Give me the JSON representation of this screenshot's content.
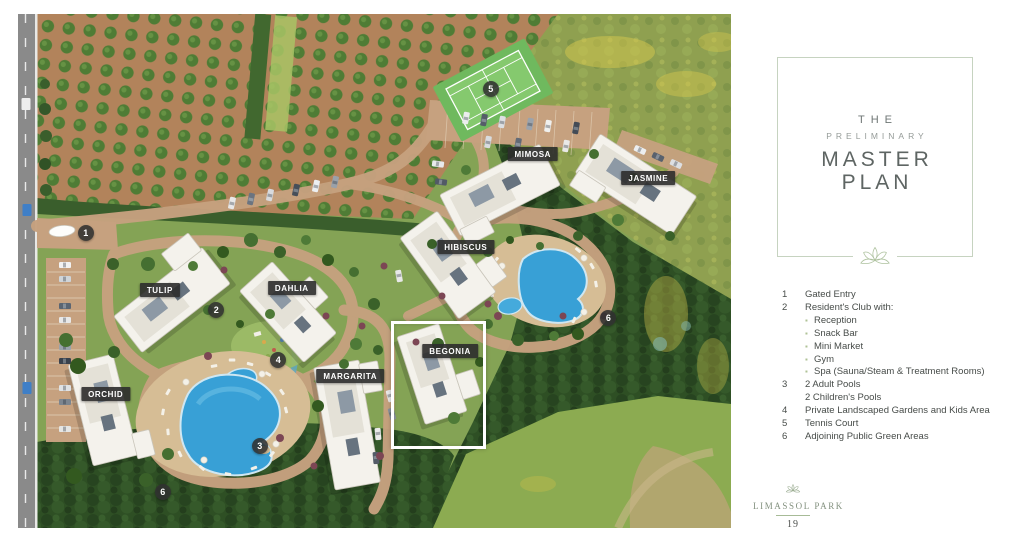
{
  "page": {
    "number": "19"
  },
  "brand": {
    "name": "LIMASSOL PARK"
  },
  "title_panel": {
    "eyebrow": "THE",
    "subtitle": "PRELIMINARY",
    "line1": "MASTER",
    "line2": "PLAN"
  },
  "legend": {
    "items": [
      {
        "num": "1",
        "lines": [
          "Gated Entry"
        ]
      },
      {
        "num": "2",
        "lines": [
          "Resident's Club with:"
        ],
        "bullets": [
          "Reception",
          "Snack Bar",
          "Mini Market",
          "Gym",
          "Spa (Sauna/Steam & Treatment Rooms)"
        ]
      },
      {
        "num": "3",
        "lines": [
          "2 Adult Pools",
          "2 Children's Pools"
        ]
      },
      {
        "num": "4",
        "lines": [
          "Private Landscaped Gardens and Kids Area"
        ]
      },
      {
        "num": "5",
        "lines": [
          "Tennis Court"
        ]
      },
      {
        "num": "6",
        "lines": [
          "Adjoining Public Green Areas"
        ]
      }
    ]
  },
  "map": {
    "building_labels": [
      {
        "name": "TULIP",
        "x": 19.9,
        "y": 53.7
      },
      {
        "name": "DAHLIA",
        "x": 38.4,
        "y": 53.3
      },
      {
        "name": "ORCHID",
        "x": 12.3,
        "y": 73.9
      },
      {
        "name": "MARGARITA",
        "x": 46.6,
        "y": 70.4
      },
      {
        "name": "BEGONIA",
        "x": 60.6,
        "y": 65.6
      },
      {
        "name": "HIBISCUS",
        "x": 62.8,
        "y": 45.3
      },
      {
        "name": "MIMOSA",
        "x": 72.2,
        "y": 27.2
      },
      {
        "name": "JASMINE",
        "x": 88.4,
        "y": 31.9
      }
    ],
    "markers": [
      {
        "n": "1",
        "x": 9.5,
        "y": 42.6
      },
      {
        "n": "2",
        "x": 27.8,
        "y": 57.6
      },
      {
        "n": "3",
        "x": 33.9,
        "y": 84.0
      },
      {
        "n": "4",
        "x": 36.5,
        "y": 67.3
      },
      {
        "n": "5",
        "x": 66.3,
        "y": 14.6
      },
      {
        "n": "6",
        "x": 82.8,
        "y": 59.1
      },
      {
        "n": "6",
        "x": 20.3,
        "y": 93.0
      }
    ],
    "highlighted_building": "BEGONIA",
    "colors": {
      "label_bg": "#2c2c2c",
      "marker_bg": "#303030",
      "pool": "#38a0d6",
      "court": "#85c96e",
      "road": "#c6a17f",
      "sage": "#c6d3c0"
    }
  }
}
